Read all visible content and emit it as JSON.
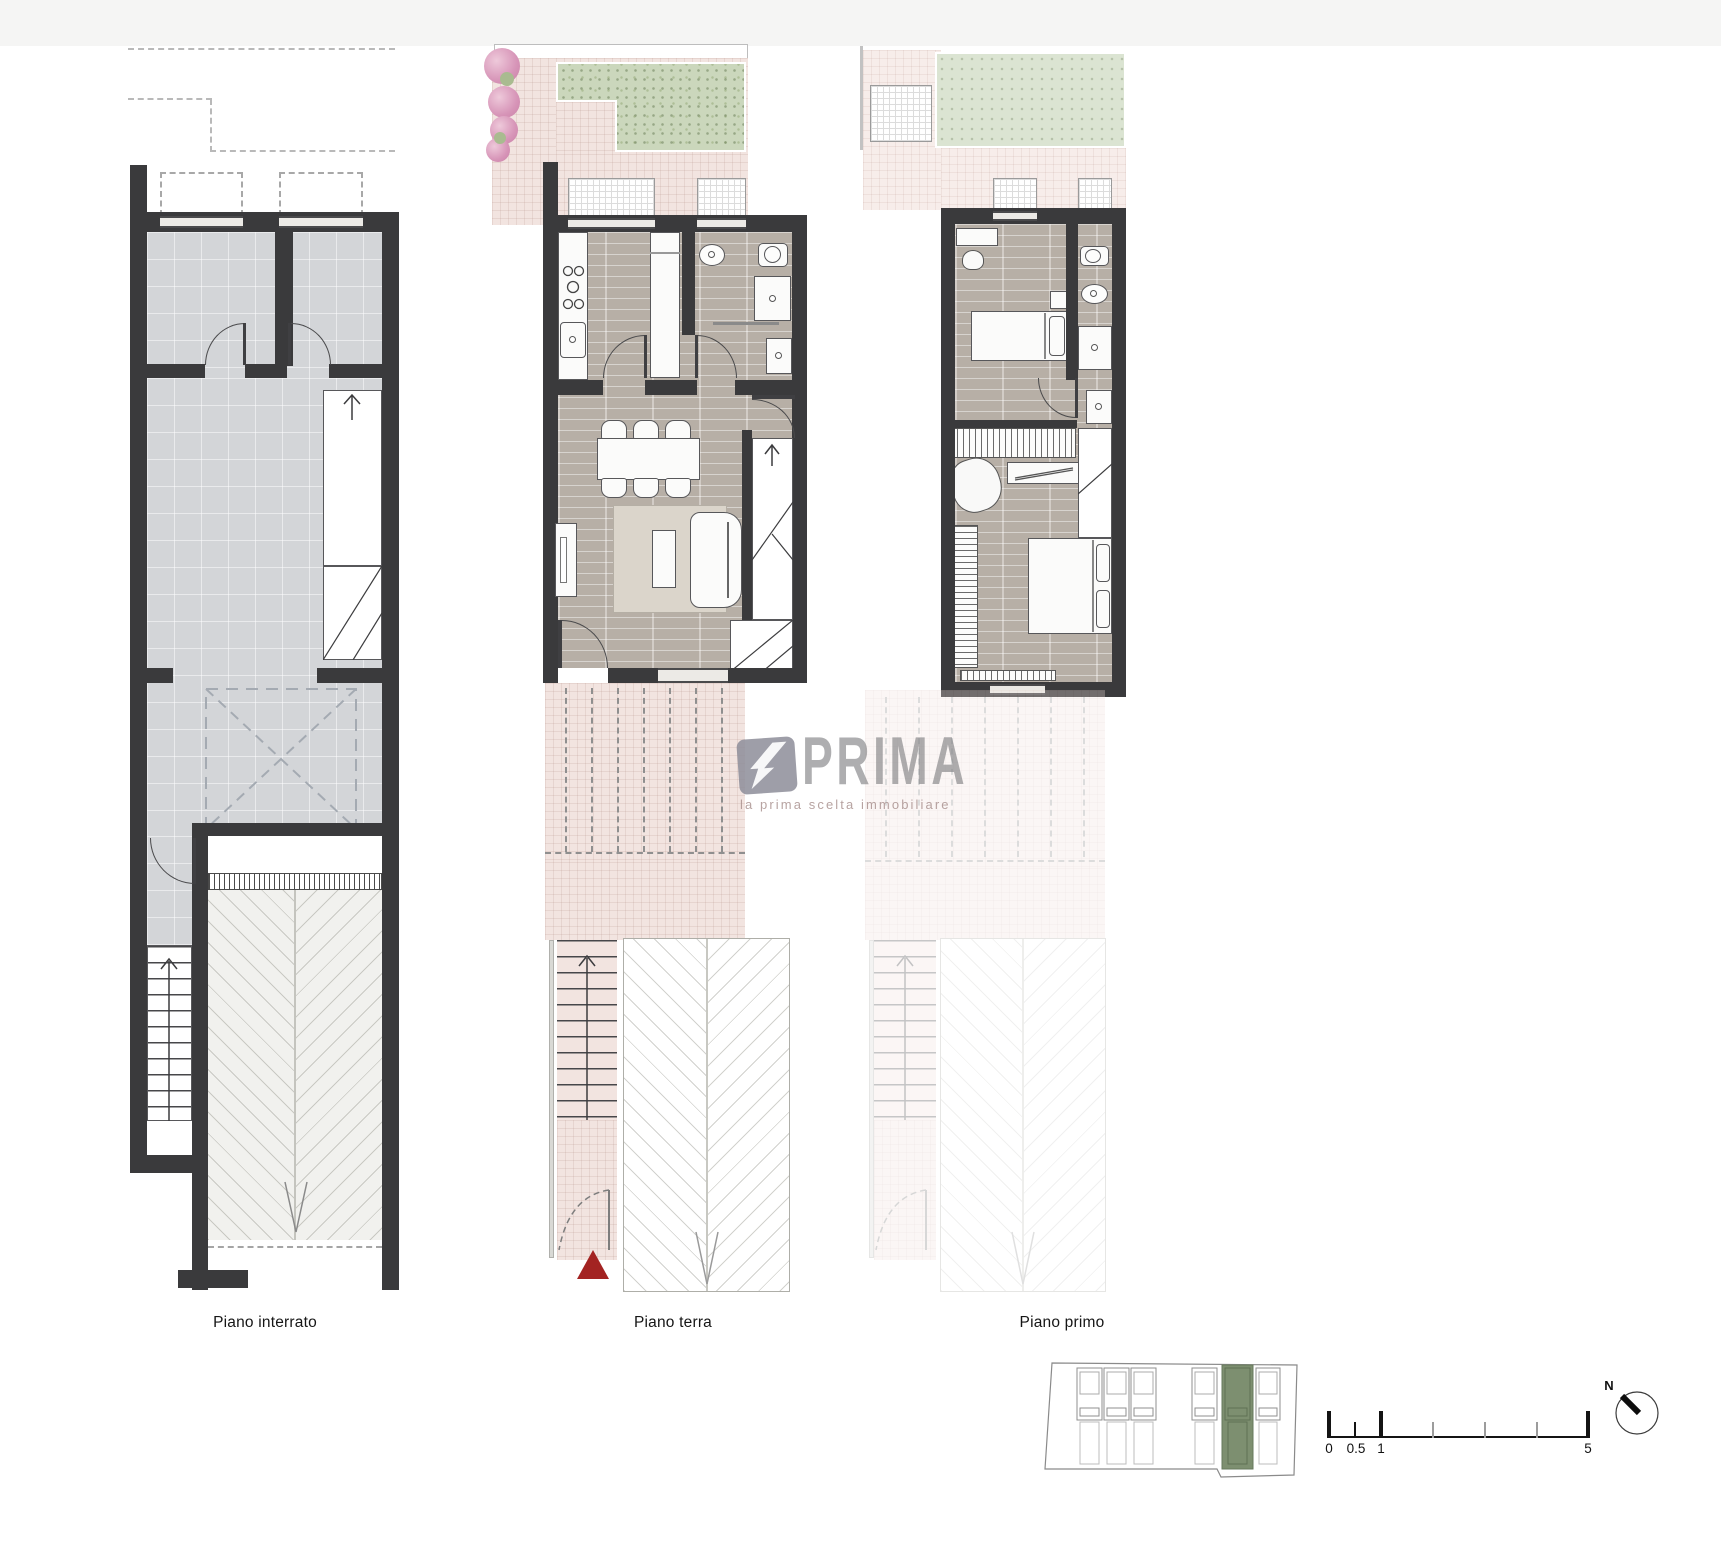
{
  "plans": {
    "interrato": {
      "label": "Piano interrato"
    },
    "terra": {
      "label": "Piano terra"
    },
    "primo": {
      "label": "Piano primo"
    }
  },
  "watermark": {
    "brand": "PRIMA",
    "tagline": "la prima scelta immobiliare"
  },
  "scalebar": {
    "labels": [
      "0",
      "0.5",
      "1",
      "5"
    ]
  },
  "compass": {
    "north_label": "N"
  },
  "colors": {
    "wall": "#3a3a3c",
    "floor-gray": "#d3d5d8",
    "floor-wood": "#b7afa6",
    "paving-pink": "#f2e4e0",
    "lawn-green": "#cbd7bc",
    "site-highlight": "#7d8f70",
    "marker-red": "#a32322",
    "watermark-gray": "#8e8e9a"
  }
}
